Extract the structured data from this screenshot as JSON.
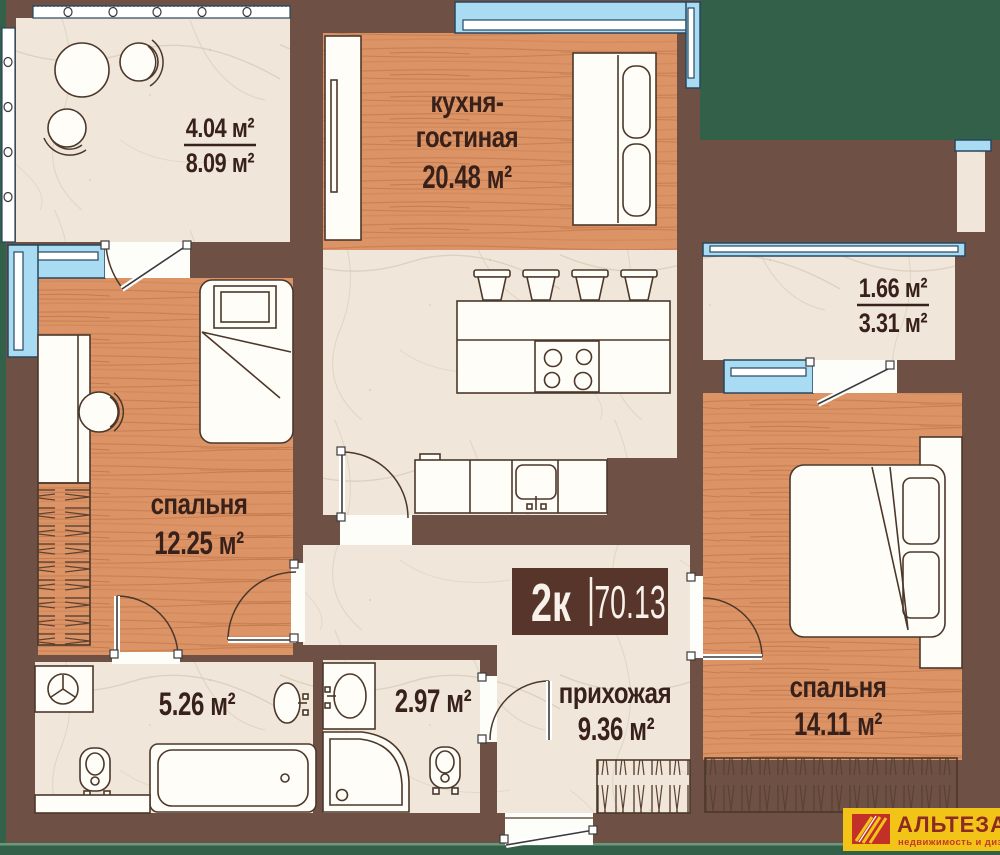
{
  "badge": {
    "rooms": "2к",
    "area": "70.13"
  },
  "rooms": {
    "balcony_top": {
      "area_reduced": "4.04 м²",
      "area_full": "8.09 м²"
    },
    "kitchen_living": {
      "name_line1": "кухня-",
      "name_line2": "гостиная",
      "area": "20.48 м²"
    },
    "balcony_right": {
      "area_reduced": "1.66 м²",
      "area_full": "3.31 м²"
    },
    "bedroom_left": {
      "name": "спальня",
      "area": "12.25 м²"
    },
    "bathroom_main": {
      "area": "5.26 м²"
    },
    "bathroom_guest": {
      "area": "2.97 м²"
    },
    "hallway": {
      "name": "прихожая",
      "area": "9.36 м²"
    },
    "bedroom_right": {
      "name": "спальня",
      "area": "14.11 м²"
    }
  },
  "logo": {
    "brand": "АЛЬТЕЗА",
    "tagline": "недвижимость и дизайн"
  },
  "colors": {
    "background_green": "#336049",
    "wall_brown": "#6e5144",
    "wood_floor": "#dc9466",
    "marble_floor": "#f0e7da",
    "window_blue": "#a9dcf2",
    "badge_brown": "#57352a",
    "label_text": "#38211a",
    "logo_yellow": "#f2c417",
    "logo_red": "#c23028"
  }
}
